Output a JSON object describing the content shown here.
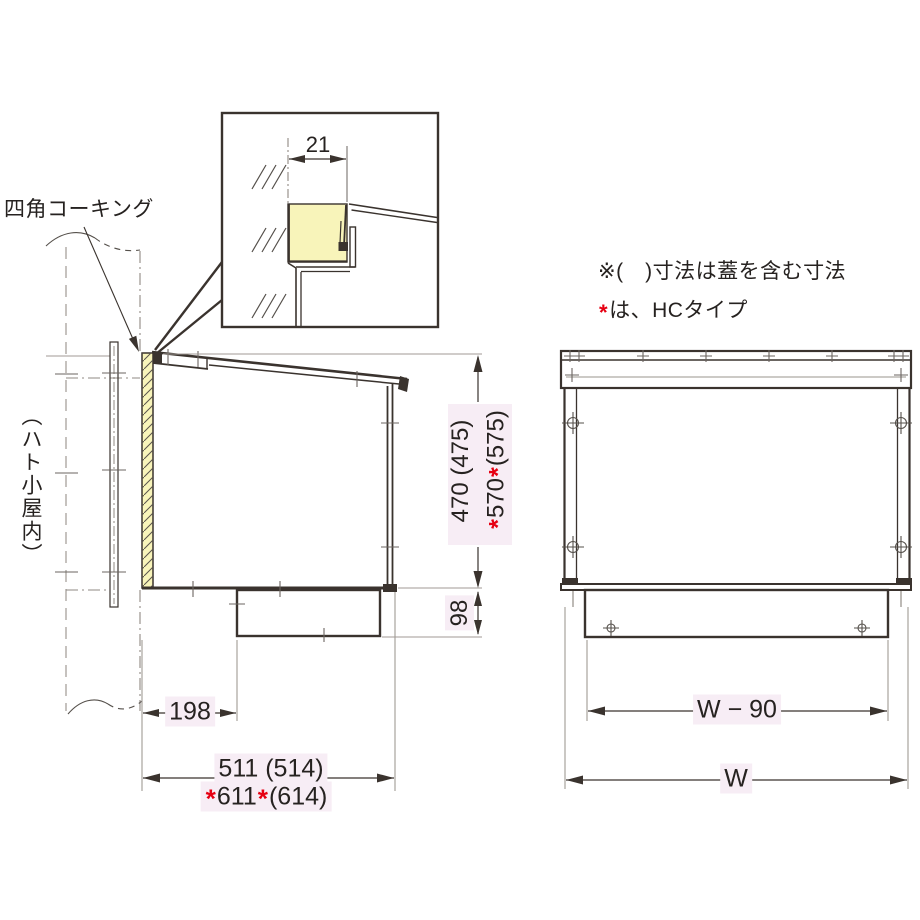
{
  "labels": {
    "caulking": "四角コーキング",
    "pigeon_house": "（ハト小屋内）"
  },
  "notes": {
    "paren_rule": "※(　)寸法は蓋を含む寸法",
    "star": "*",
    "star_rule": "は、HCタイプ"
  },
  "detail_inset": {
    "lip_width": "21"
  },
  "side_view": {
    "height_std": "470 (475)",
    "height_hc": {
      "s1": "*",
      "value": "570",
      "s2": "*",
      "paren": "(575)"
    },
    "base_height": "98",
    "wall_offset": "198",
    "depth_std": "511 (514)",
    "depth_hc": {
      "s1": "*",
      "value": "611",
      "s2": "*",
      "paren": "(614)"
    }
  },
  "front_view": {
    "body_width": "W − 90",
    "overall_width": "W"
  },
  "colors": {
    "accent_red": "#e60012",
    "caulking_yellow": "#f8f4ba",
    "dim_label_bg": "#f7edf5",
    "line_dark": "#3a332e",
    "line_gray": "#a09a94"
  }
}
